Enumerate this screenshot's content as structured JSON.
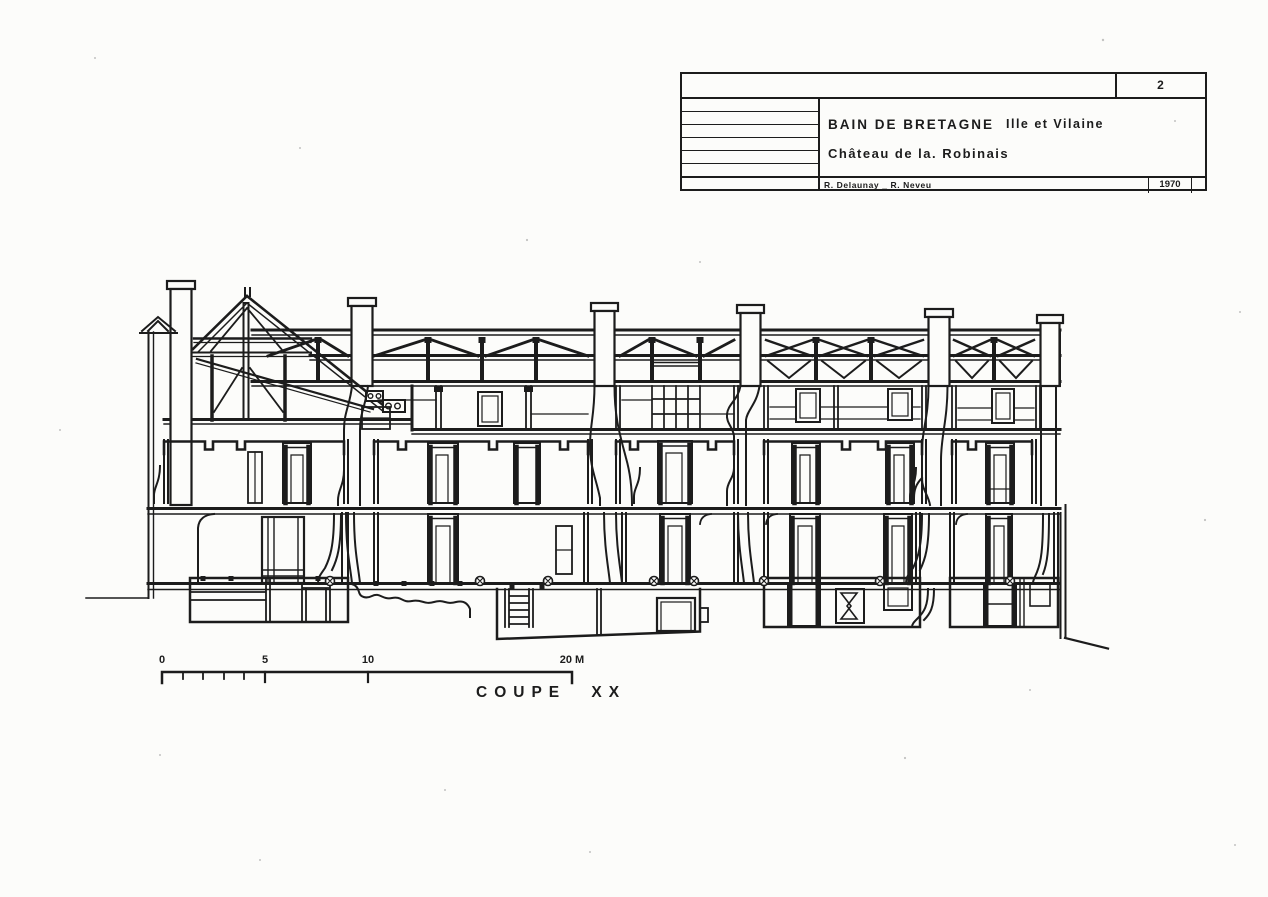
{
  "title_block": {
    "sheet_number": "2",
    "commune": "BAIN DE BRETAGNE",
    "departement": "Ille et Vilaine",
    "building": "Château de la. Robinais",
    "authors": "R. Delaunay _ R. Neveu",
    "year": "1970"
  },
  "drawing": {
    "caption": "COUPE XX"
  },
  "scale_bar": {
    "tick_labels": [
      "0",
      "5",
      "10",
      "20 M"
    ]
  },
  "colors": {
    "ink": "#1c1c1c",
    "paper": "#fcfcfa"
  }
}
